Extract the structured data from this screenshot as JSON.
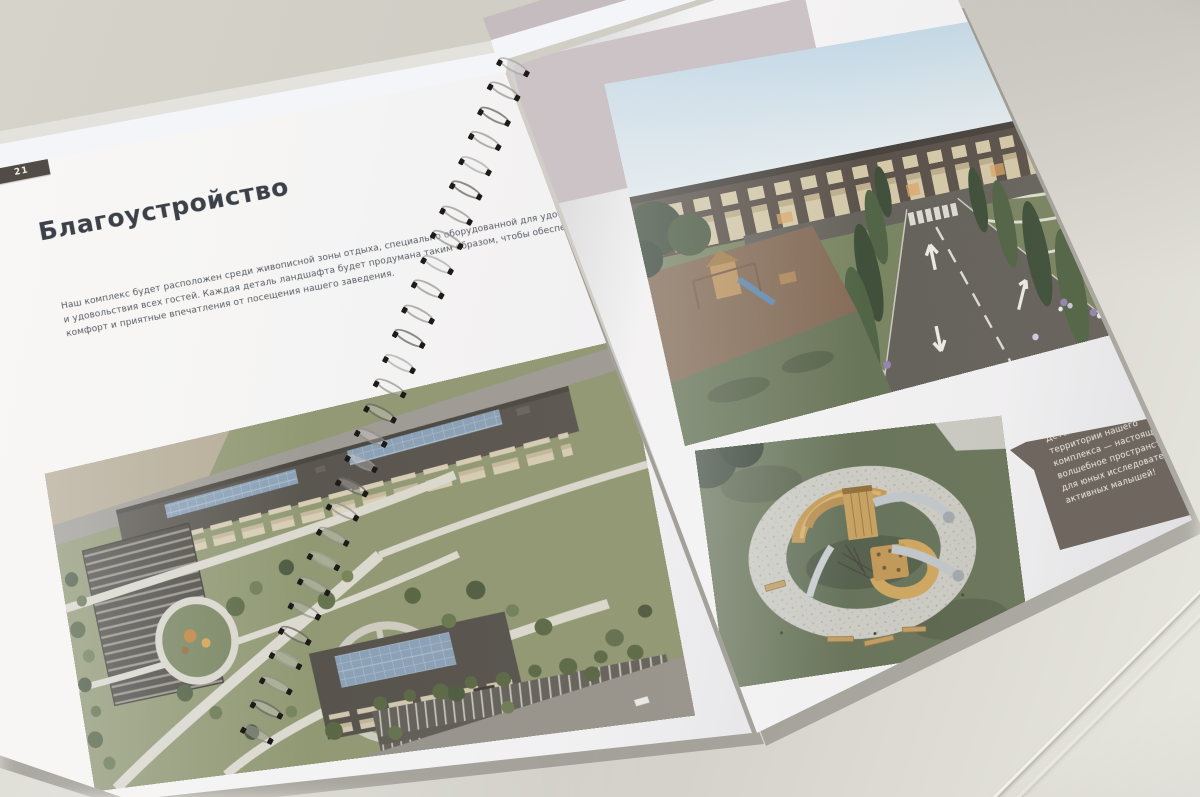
{
  "booklet": {
    "left_page": {
      "page_number": "21",
      "title": "Благоустройство",
      "body_lines": [
        "Наш комплекс будет расположен среди живописной зоны отдыха, специально оборудованной для удобства",
        "и удовольствия всех гостей. Каждая деталь ландшафта будет продумана таким образом, чтобы обеспечить",
        "комфорт и приятные впечатления от посещения нашего заведения."
      ]
    },
    "right_page": {
      "callout_lines": [
        "Детская площадка на",
        "территории нашего",
        "комплекса — настоящее",
        "волшебное пространство",
        "для юных исследователей и",
        "активных малышей!"
      ]
    }
  },
  "colors": {
    "desk": "#d3d1c7",
    "page": "#f2f1f2",
    "accent_block": "#cdc3c6",
    "callout_bg": "#6e665e",
    "callout_text": "#efece4",
    "title_text": "#3c4049",
    "page_tab_bg": "#524c46"
  }
}
